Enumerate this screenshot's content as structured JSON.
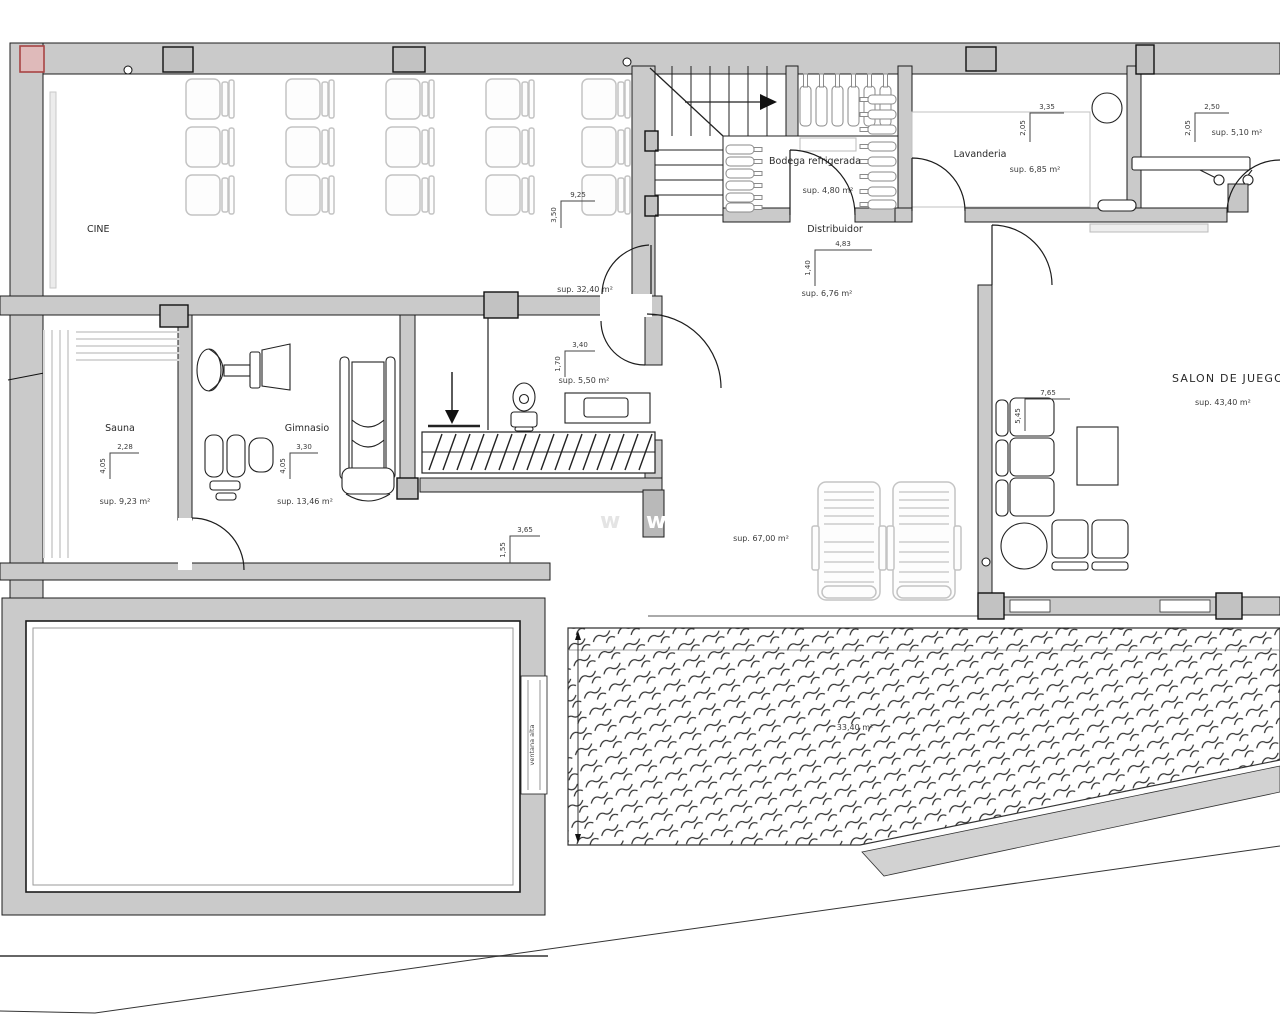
{
  "plan": {
    "title_note": "basement floor plan",
    "watermark": "w",
    "rooms": {
      "cine": {
        "label": "CINE",
        "area": "sup. 32,40 m²",
        "dim_w": "9,25",
        "dim_h": "3,50"
      },
      "sauna": {
        "label": "Sauna",
        "area": "sup. 9,23 m²",
        "dim_w": "2,28",
        "dim_h": "4,05"
      },
      "gimnasio": {
        "label": "Gimnasio",
        "area": "sup. 13,46 m²",
        "dim_w": "3,30",
        "dim_h": "4,05"
      },
      "bodega": {
        "label": "Bodega refrigerada",
        "area": "sup. 4,80 m²"
      },
      "distribuidor": {
        "label": "Distribuidor",
        "area": "sup. 6,76 m²",
        "dim_w": "4,83",
        "dim_h": "1,40"
      },
      "lavanderia": {
        "label": "Lavanderia",
        "area": "sup. 6,85 m²",
        "dim_w": "3,35",
        "dim_h": "2,05"
      },
      "plancha": {
        "area": "sup. 5,10 m²",
        "dim_w": "2,50",
        "dim_h": "2,05"
      },
      "aseo": {
        "area": "sup. 5,50 m²",
        "dim_w": "3,40",
        "dim_h": "1,70"
      },
      "estar": {
        "area": "sup. 67,00 m²",
        "dim_w": "3,65",
        "dim_h": "1,55"
      },
      "salon": {
        "label": "SALON DE JUEGOS",
        "area": "sup. 43,40 m²",
        "dim_w": "7,65",
        "dim_h": "5,45"
      },
      "terraza": {
        "area": "33,40 m²"
      }
    },
    "annotations": {
      "ventana_alta": "ventana alta"
    },
    "colors": {
      "wall": "#cacaca",
      "line": "#1c1c1c",
      "furniture_light": "#c4c4c4",
      "red_marker": "#a84444"
    }
  }
}
